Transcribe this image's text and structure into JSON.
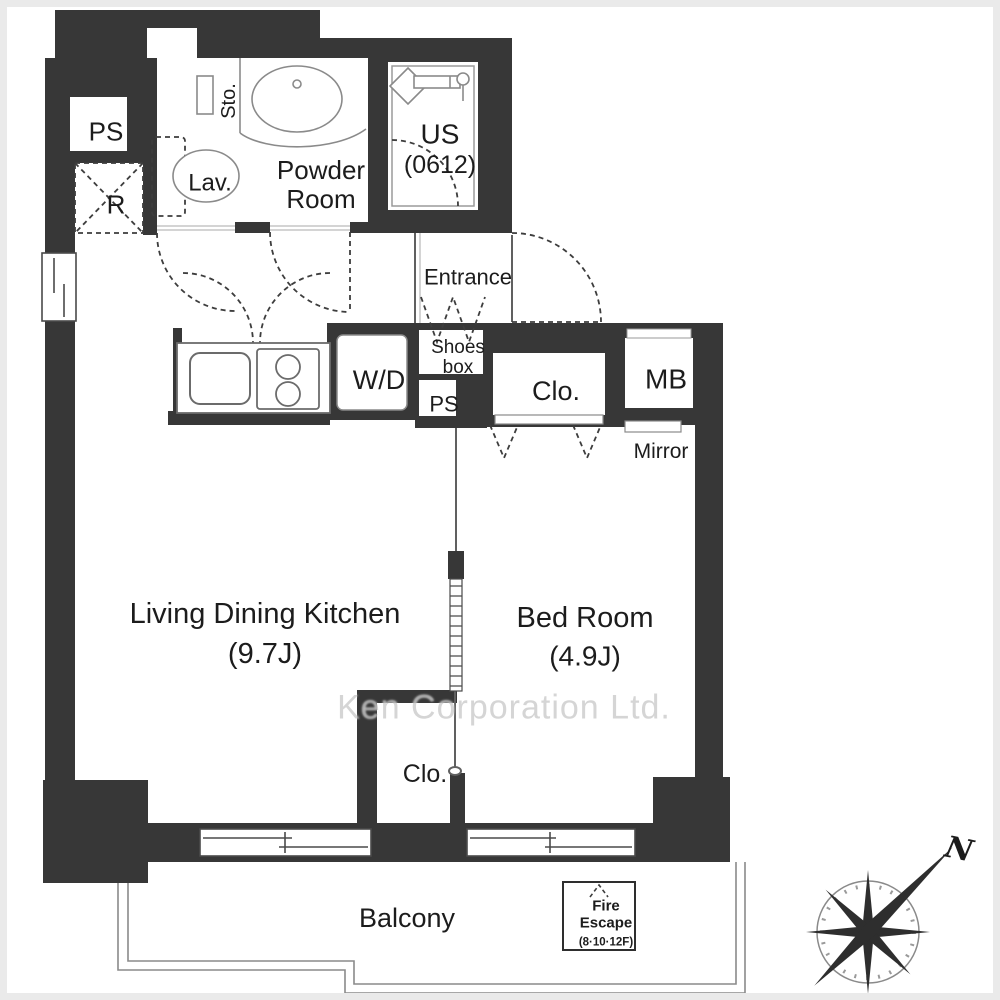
{
  "colors": {
    "wall": "#373737",
    "thin_line": "#606060",
    "dash_line": "#3d3d3d",
    "fixture_line": "#8a8a8a",
    "frame": "#eaeaea",
    "watermark": "#c9c9c9"
  },
  "watermark": "Ken Corporation Ltd.",
  "compass": {
    "north": "N"
  },
  "rooms": {
    "ldk": {
      "name": "Living Dining Kitchen",
      "size": "(9.7J)"
    },
    "bedroom": {
      "name": "Bed Room",
      "size": "(4.9J)"
    },
    "powder_room": {
      "name": "Powder Room"
    },
    "unit_bath": {
      "name": "US",
      "size": "(0612)"
    },
    "entrance": {
      "name": "Entrance"
    },
    "balcony": {
      "name": "Balcony"
    }
  },
  "fixtures": {
    "pipe_space_top": "PS",
    "pipe_space_hall": "PS",
    "refrigerator": "R",
    "storage": "Sto.",
    "lavatory": "Lav.",
    "shoes_box": "Shoes box",
    "washer_dryer": "W/D",
    "closet_hall": "Clo.",
    "closet_ldk": "Clo.",
    "meter_box": "MB",
    "mirror": "Mirror"
  },
  "fire_escape": {
    "name": "Fire Escape",
    "floors": "(8·10·12F)"
  }
}
